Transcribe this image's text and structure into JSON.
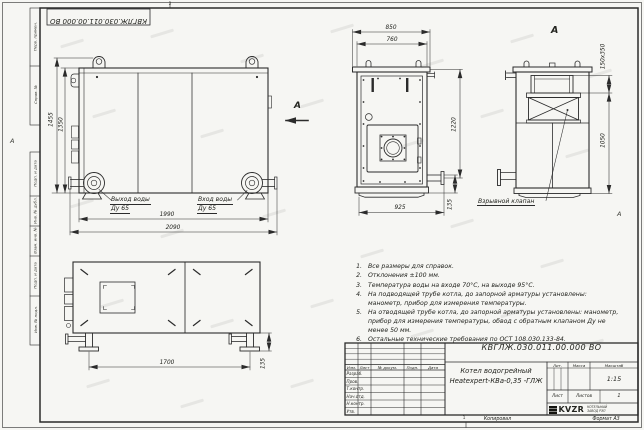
{
  "sheet": {
    "stamp_top": "КВГЛЖ.030.011.00.000 ВО",
    "fold_mark_top": "2",
    "fold_mark_bottom": "1",
    "zone_left": "А",
    "zone_right": "А",
    "margin_labels": [
      "Перв. примен.",
      "Справ. №",
      "Подп. и дата",
      "Инв. № дубл.",
      "Взам. инв. №",
      "Подп. и дата",
      "Инв. № подл."
    ]
  },
  "views": {
    "side": {
      "dim_height_outer": "1455",
      "dim_height_inner": "1350",
      "dim_width_inner": "1990",
      "dim_width_outer": "2090",
      "outlet_line1": "Выход воды",
      "outlet_line2": "Ду 65",
      "inlet_line1": "Вход воды",
      "inlet_line2": "Ду 65",
      "view_arrow_label": "А"
    },
    "front": {
      "dim_width_outer": "850",
      "dim_width_inner": "760",
      "dim_height": "1220",
      "dim_pipe_offset": "135",
      "dim_width_bottom": "925"
    },
    "view_a": {
      "title": "А",
      "dim_flue": "150х350",
      "dim_height": "1050",
      "callout_explosion_valve": "Взрывной клапан"
    },
    "opposite": {
      "dim_leg_span": "1700",
      "dim_foot_height": "135"
    }
  },
  "notes": {
    "items": [
      {
        "num": "1.",
        "text": "Все размеры для справок."
      },
      {
        "num": "2.",
        "text": "Отклонения ±100 мм."
      },
      {
        "num": "3.",
        "text": "Температура воды на входе 70°С, на выходе 95°С."
      },
      {
        "num": "4.",
        "text": "На подводящей трубе котла, до запорной арматуры установлены: манометр, прибор для измерения температуры."
      },
      {
        "num": "5.",
        "text": "На отводящей трубе котла, до запорной арматуры установлены: манометр, прибор для измерения температуры, обвод с обратным клапаном Ду не менее 50 мм."
      },
      {
        "num": "6.",
        "text": "Остальные технические требования по ОСТ 108.030.133-84."
      }
    ]
  },
  "title_block": {
    "doc_number": "КВГЛЖ.030.011.00.000 ВО",
    "product_name_line1": "Котел водогрейный",
    "product_name_line2": "Heatexpert-КВа-0,35 -ГЛЖ",
    "change_cols": [
      "Изм.",
      "Лист",
      "№ докум.",
      "Подп.",
      "Дата"
    ],
    "sign_rows": [
      "Разраб.",
      "Пров.",
      "Т.контр.",
      "Нач.отд.",
      "Н.контр.",
      "Утв."
    ],
    "lit_label": "Лит.",
    "mass_label": "Масса",
    "scale_label": "Масштаб",
    "scale_value": "1:15",
    "sheet_label": "Лист",
    "sheets_label": "Листов",
    "sheets_value": "1",
    "company_logo": "KVZR",
    "company_name_line1": "КОТЕЛЬНЫЙ",
    "company_name_line2": "ЗАВОД РЭП",
    "footer_copy": "Копировал",
    "footer_format": "Формат А3"
  }
}
